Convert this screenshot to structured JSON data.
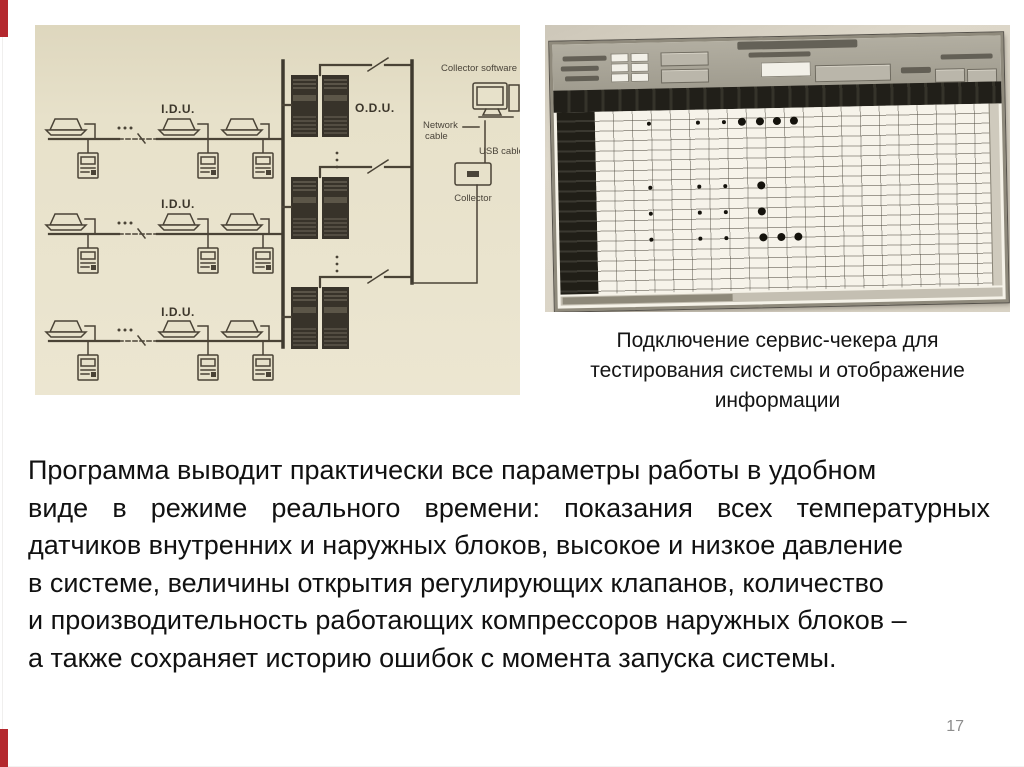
{
  "slide": {
    "page_number": "17",
    "accent_color": "#b4282e"
  },
  "diagram_photo": {
    "labels": {
      "idu": "I.D.U.",
      "odu": "O.D.U.",
      "collector_software": "Collector software",
      "network_cable_line1": "Network",
      "network_cable_line2": "cable",
      "usb_cable": "USB cable",
      "collector": "Collector"
    }
  },
  "screen_photo": {
    "caption_lines": [
      "Подключение сервис-чекера для",
      "тестирования системы и отображение",
      "информации"
    ],
    "indicator_dots": [
      {
        "x": 95,
        "y": 81,
        "r": 2
      },
      {
        "x": 144,
        "y": 81,
        "r": 2
      },
      {
        "x": 170,
        "y": 81,
        "r": 2
      },
      {
        "x": 188,
        "y": 81,
        "r": 4
      },
      {
        "x": 206,
        "y": 81,
        "r": 4
      },
      {
        "x": 223,
        "y": 81,
        "r": 4
      },
      {
        "x": 240,
        "y": 81,
        "r": 4
      },
      {
        "x": 95,
        "y": 145,
        "r": 2
      },
      {
        "x": 144,
        "y": 145,
        "r": 2
      },
      {
        "x": 170,
        "y": 145,
        "r": 2
      },
      {
        "x": 206,
        "y": 145,
        "r": 4
      },
      {
        "x": 95,
        "y": 171,
        "r": 2
      },
      {
        "x": 144,
        "y": 171,
        "r": 2
      },
      {
        "x": 170,
        "y": 171,
        "r": 2
      },
      {
        "x": 206,
        "y": 171,
        "r": 4
      },
      {
        "x": 95,
        "y": 197,
        "r": 2
      },
      {
        "x": 144,
        "y": 197,
        "r": 2
      },
      {
        "x": 170,
        "y": 197,
        "r": 2
      },
      {
        "x": 207,
        "y": 197,
        "r": 4
      },
      {
        "x": 225,
        "y": 197,
        "r": 4
      },
      {
        "x": 242,
        "y": 197,
        "r": 4
      }
    ]
  },
  "body_text": {
    "lines": [
      "Программа выводит практически все параметры работы в удобном",
      "виде в режиме реального времени: показания всех температурных",
      "датчиков внутренних и наружных блоков, высокое и низкое давление",
      "в системе, величины открытия регулирующих клапанов, количество",
      "и производительность работающих компрессоров наружных блоков –",
      "а также сохраняет историю ошибок с момента запуска системы."
    ]
  }
}
